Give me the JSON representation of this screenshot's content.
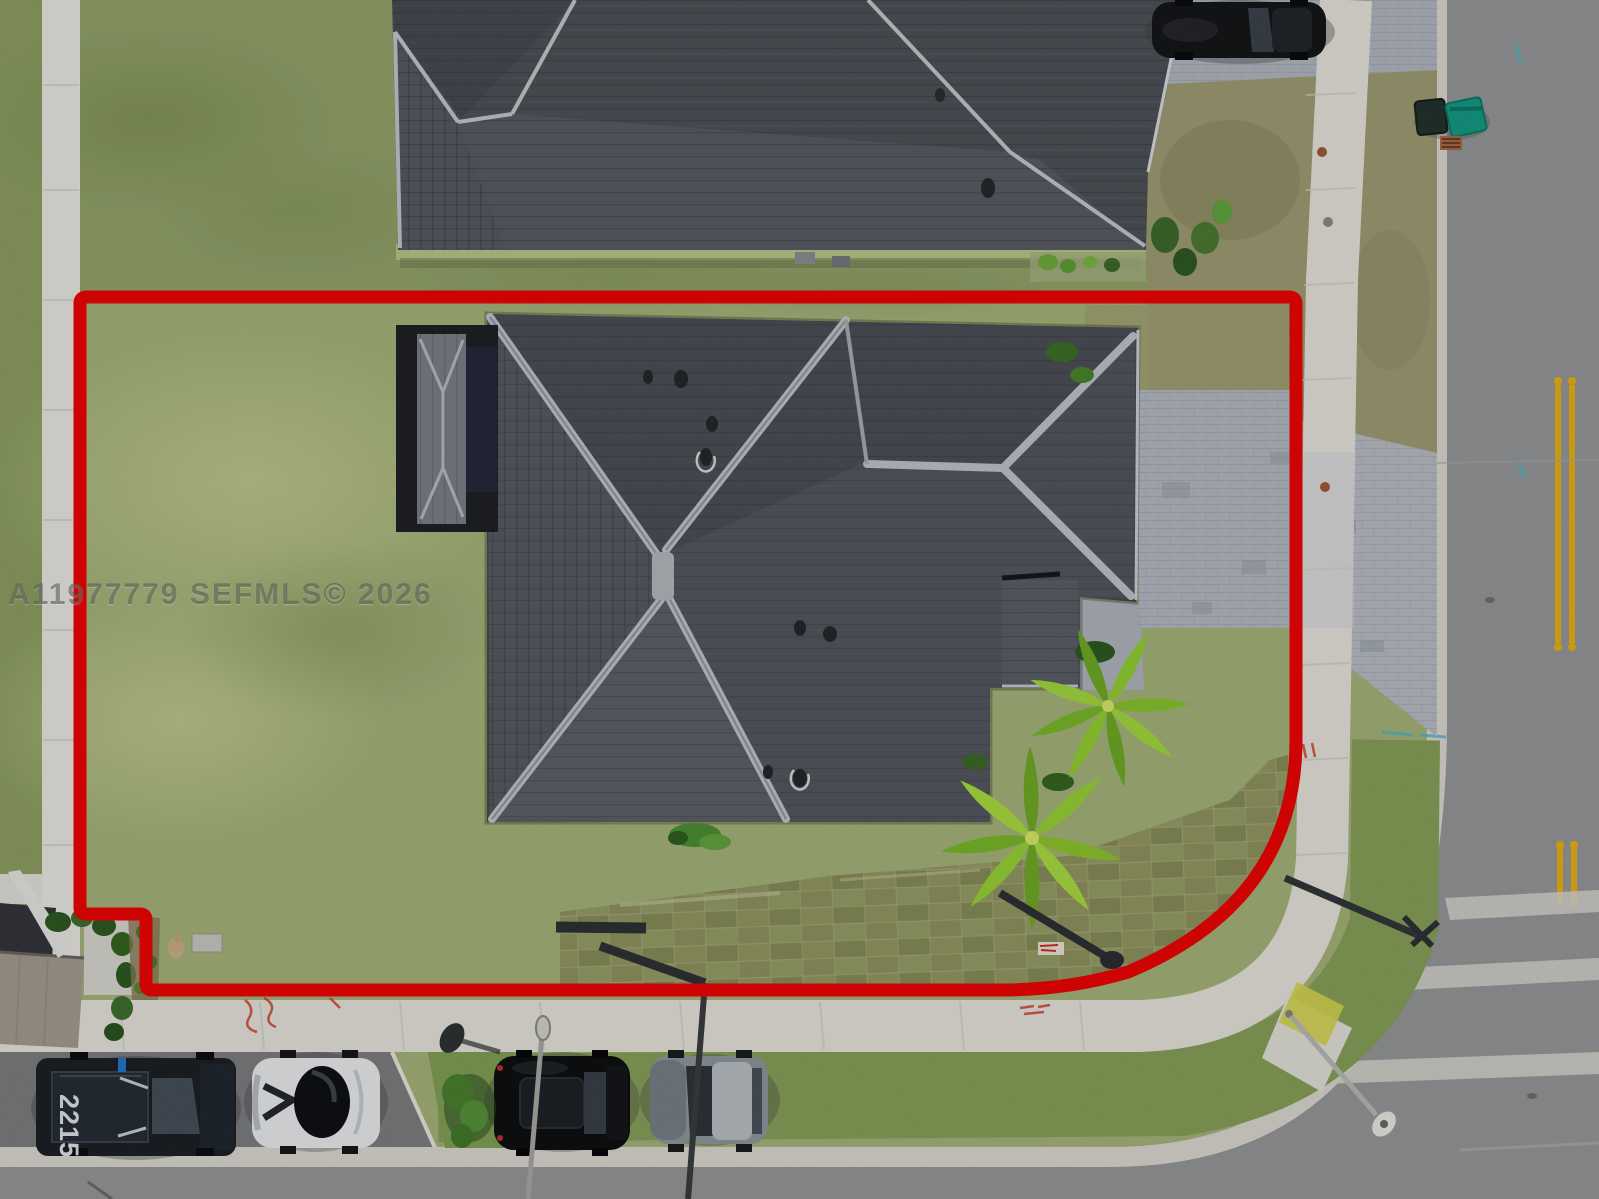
{
  "scene": {
    "description": "Aerial drone photo of a corner-lot single-family home outlined with a red property boundary",
    "view": "top-down"
  },
  "watermark": {
    "text": "A11977779 SEFMLS© 2026"
  },
  "vehicles": {
    "truck_number": "2215"
  },
  "colors": {
    "boundary_red": "#ee0404",
    "lawn_green": "#a5b37a",
    "roof_dark_gray": "#53575e",
    "ridge_cap_gray": "#c0c5cb",
    "road_asphalt": "#97989a",
    "sidewalk_concrete": "#e6e4dc",
    "paver_driveway": "#b5bac3",
    "centerline_yellow": "#e8b213",
    "palm_green": "#8fc52f",
    "trash_bin_teal": "#159b84",
    "fascia_green": "#b9c689"
  }
}
